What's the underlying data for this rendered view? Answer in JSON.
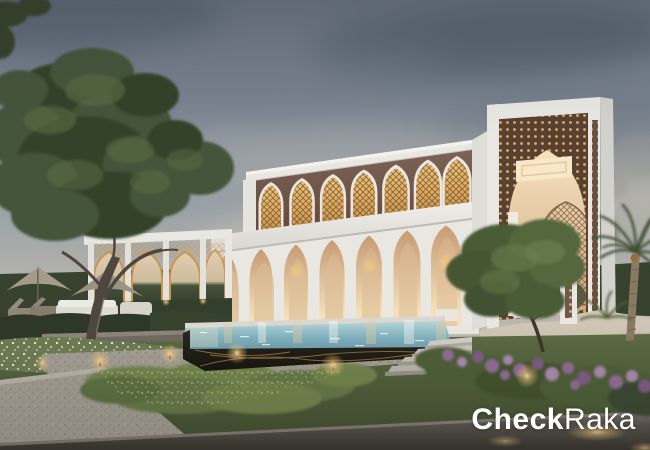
{
  "watermark": {
    "text_bold": "Check",
    "text_light": "Raka"
  },
  "palette": {
    "sky_top": "#67717d",
    "sky_mid": "#98a0a6",
    "sky_low": "#c1bab0",
    "logo_color": "#ffffff",
    "building_white": "#e9e7e2",
    "building_shade": "#d3d1cc",
    "terracotta": "#63493c",
    "terracotta_light": "#7d6355",
    "gold_light": "#e9c379",
    "gold": "#c9974f",
    "gold_dark": "#6d4a2e",
    "lattice_dark_bg": "#5a4031",
    "interior_warm": "#f4dfb8",
    "interior_deep": "#c79a74",
    "water_light": "#b5d4d8",
    "water": "#7fb0bd",
    "water_deep": "#6e9dac",
    "pool_black": "#17150f",
    "gold_vein": "#b98f4a",
    "lawn": "#5c6b42",
    "lawn_dark": "#414e30",
    "groundcover": "#72854e",
    "foliage": "#45543a",
    "foliage_dark": "#36432c",
    "foliage_light": "#5d7045",
    "hedge": "#37422f",
    "path": "#a39e94",
    "path_light": "#c9c5bb",
    "road": "#5a564f",
    "road_dark": "#38352f",
    "purple": "#916d95",
    "purple_light": "#ab8aae",
    "light_glow": "#f5c87a",
    "light_core": "#ffe3b0",
    "umbrella": "#a59b8c",
    "trunk": "#4d473f",
    "palm_trunk": "#8a7a62"
  }
}
